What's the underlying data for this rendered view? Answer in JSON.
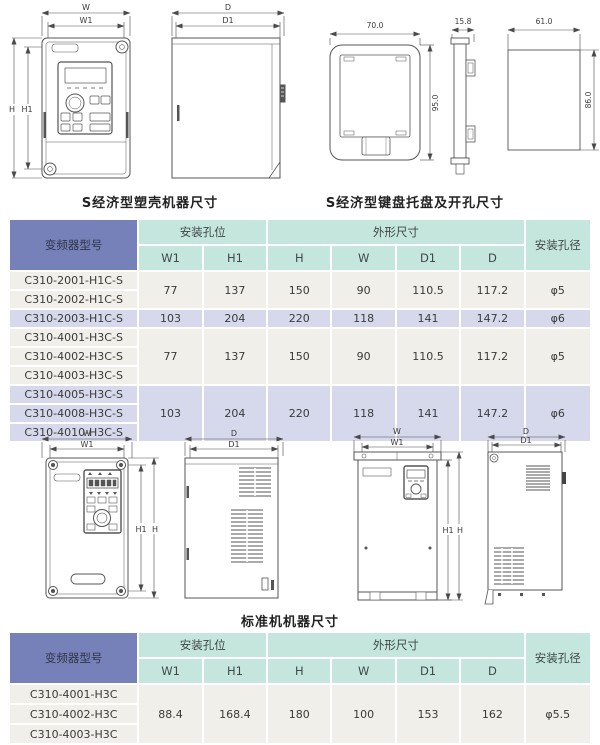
{
  "colors": {
    "model_header_bg": "#7781b9",
    "group_header_bg": "#c5e6dd",
    "row_normal_bg": "#f0efe9",
    "row_highlight_bg": "#d5d9eb",
    "drawing_line": "#4a4a4a"
  },
  "captions": {
    "top_left": "S经济型塑壳机器尺寸",
    "top_right": "S经济型键盘托盘及开孔尺寸",
    "middle": "标准机机器尺寸"
  },
  "drawings": {
    "labels": {
      "w": "W",
      "w1": "W1",
      "h": "H",
      "h1": "H1",
      "d": "D",
      "d1": "D1"
    },
    "tray": {
      "width": "70.0",
      "height": "95.0",
      "thickness": "15.8",
      "cutout_width": "61.0",
      "cutout_height": "86.0"
    }
  },
  "table1": {
    "headers": {
      "model": "变频器型号",
      "mount_group": "安装孔位",
      "outline_group": "外形尺寸",
      "hole": "安装孔径",
      "cols": [
        "W1",
        "H1",
        "H",
        "W",
        "D1",
        "D"
      ]
    },
    "row_groups": [
      {
        "models": [
          "C310-2001-H1C-S",
          "C310-2002-H1C-S"
        ],
        "values": [
          "77",
          "137",
          "150",
          "90",
          "110.5",
          "117.2",
          "φ5"
        ],
        "highlight": false
      },
      {
        "models": [
          "C310-2003-H1C-S"
        ],
        "values": [
          "103",
          "204",
          "220",
          "118",
          "141",
          "147.2",
          "φ6"
        ],
        "highlight": true
      },
      {
        "models": [
          "C310-4001-H3C-S",
          "C310-4002-H3C-S",
          "C310-4003-H3C-S"
        ],
        "values": [
          "77",
          "137",
          "150",
          "90",
          "110.5",
          "117.2",
          "φ5"
        ],
        "highlight": false
      },
      {
        "models": [
          "C310-4005-H3C-S",
          "C310-4008-H3C-S",
          "C310-4010-H3C-S"
        ],
        "values": [
          "103",
          "204",
          "220",
          "118",
          "141",
          "147.2",
          "φ6"
        ],
        "highlight": true
      }
    ]
  },
  "table2": {
    "headers": {
      "model": "变频器型号",
      "mount_group": "安装孔位",
      "outline_group": "外形尺寸",
      "hole": "安装孔径",
      "cols": [
        "W1",
        "H1",
        "H",
        "W",
        "D1",
        "D"
      ]
    },
    "row_groups": [
      {
        "models": [
          "C310-4001-H3C",
          "C310-4002-H3C",
          "C310-4003-H3C"
        ],
        "values": [
          "88.4",
          "168.4",
          "180",
          "100",
          "153",
          "162",
          "φ5.5"
        ],
        "highlight": false
      }
    ]
  }
}
